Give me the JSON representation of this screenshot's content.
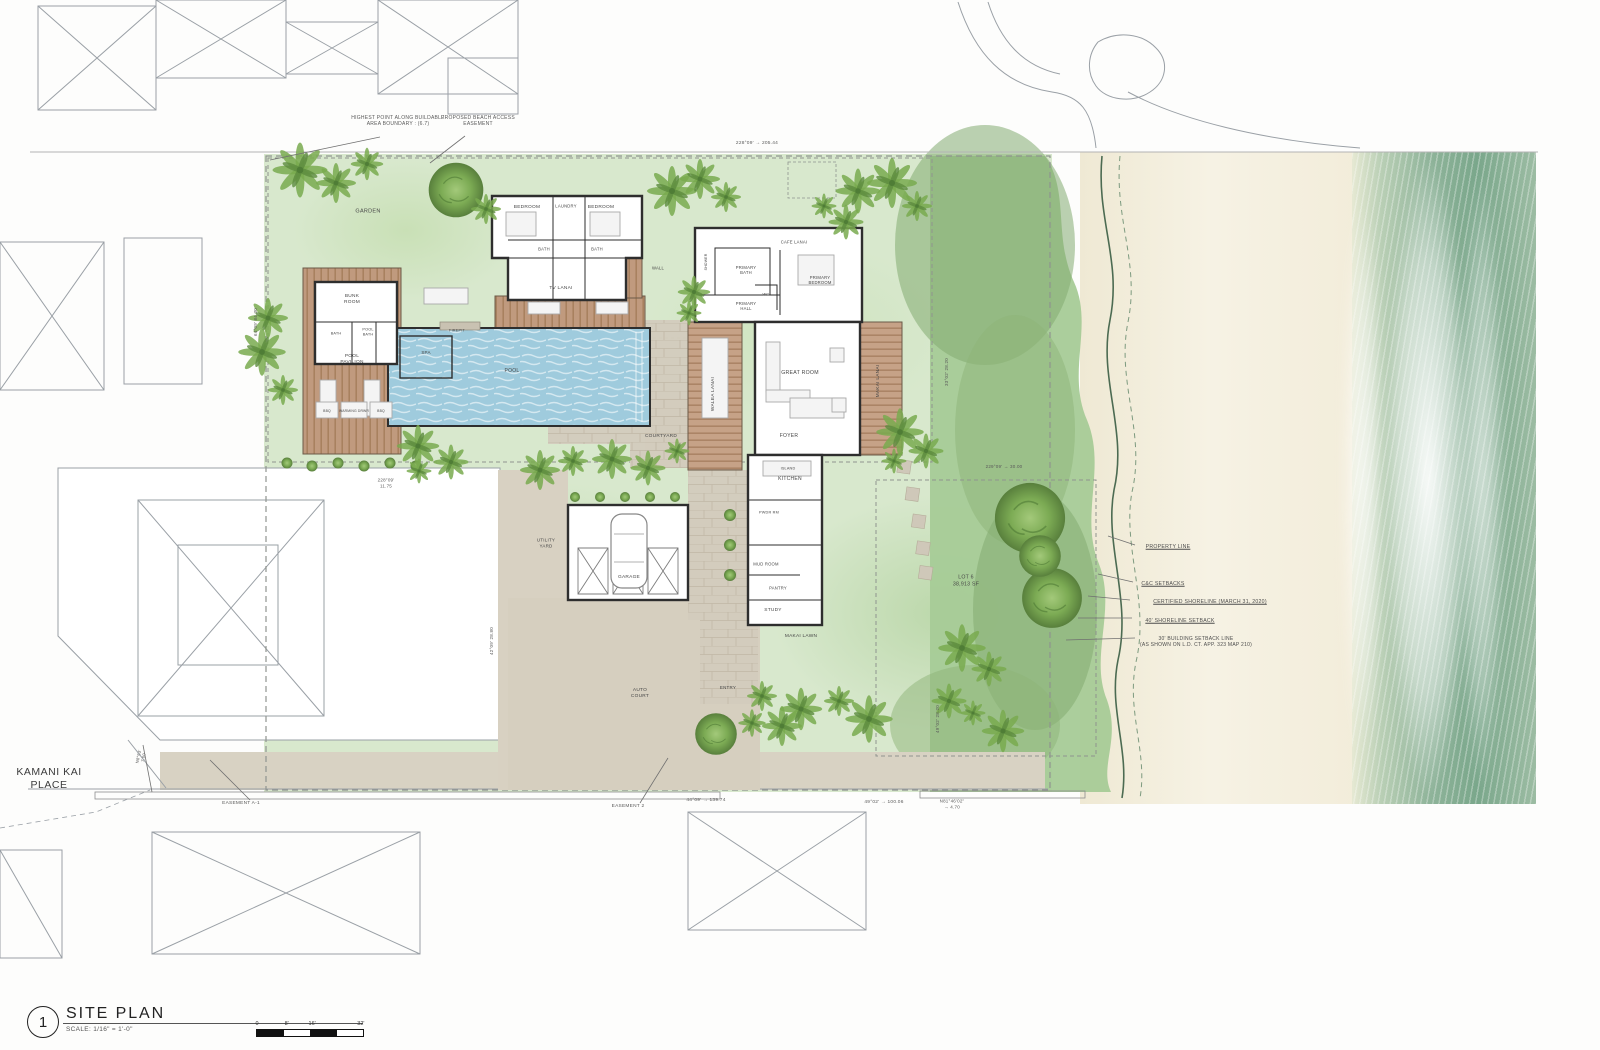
{
  "title_block": {
    "number": "1",
    "title": "SITE PLAN",
    "scale_note": "SCALE: 1/16\" =    1'-0\"",
    "ticks": [
      "0",
      "8'",
      "16'",
      "32'"
    ]
  },
  "street": {
    "name": "KAMANI KAI\nPLACE"
  },
  "site": {
    "lot_label": "LOT 6",
    "lot_area": "38,913 SF"
  },
  "colors": {
    "lawn": "#d8e8cd",
    "dune": "#a6cb97",
    "sand": "#f6f2e4",
    "ocean": "#7aa78b",
    "pool": "#9fcbdd",
    "deck": "#c09a7e",
    "wall": "#2e2e2e",
    "pavement": "#d8d1c2",
    "stone": "#d3ccbd",
    "neighbor_line": "#9aa0a6",
    "text": "#474747"
  },
  "labels": [
    {
      "n": "street-label",
      "t": "KAMANI KAI\nPLACE",
      "x": 49,
      "y": 779,
      "s": 10.5,
      "c": "#3c3c3c"
    },
    {
      "n": "label-garden",
      "t": "GARDEN",
      "x": 368,
      "y": 212,
      "s": 5.5
    },
    {
      "n": "label-bedroom-1",
      "t": "BEDROOM",
      "x": 527,
      "y": 208,
      "s": 4.8
    },
    {
      "n": "label-laundry",
      "t": "LAUNDRY",
      "x": 566,
      "y": 206,
      "s": 4.2
    },
    {
      "n": "label-bedroom-2",
      "t": "BEDROOM",
      "x": 601,
      "y": 208,
      "s": 4.8
    },
    {
      "n": "label-bath-1",
      "t": "BATH",
      "x": 544,
      "y": 249,
      "s": 4.2
    },
    {
      "n": "label-bath-2",
      "t": "BATH",
      "x": 597,
      "y": 249,
      "s": 4.2
    },
    {
      "n": "label-tv-lanai",
      "t": "TV LANAI",
      "x": 561,
      "y": 289,
      "s": 4.8
    },
    {
      "n": "label-cafe-lanai",
      "t": "CAFE LANAI",
      "x": 794,
      "y": 242,
      "s": 4.2
    },
    {
      "n": "label-primary-bath",
      "t": "PRIMARY\nBATH",
      "x": 746,
      "y": 270,
      "s": 4.2
    },
    {
      "n": "label-shower",
      "t": "SHOWER",
      "x": 706,
      "y": 262,
      "s": 3.5,
      "r": -90
    },
    {
      "n": "label-wc",
      "t": "WC",
      "x": 766,
      "y": 294,
      "s": 4
    },
    {
      "n": "label-primary-bedroom",
      "t": "PRIMARY\nBEDROOM",
      "x": 820,
      "y": 280,
      "s": 4.2
    },
    {
      "n": "label-primary-hall",
      "t": "PRIMARY\nHALL",
      "x": 746,
      "y": 306,
      "s": 4.2
    },
    {
      "n": "label-wall",
      "t": "WALL",
      "x": 658,
      "y": 268,
      "s": 4.2
    },
    {
      "n": "label-great-room",
      "t": "GREAT ROOM",
      "x": 800,
      "y": 373,
      "s": 5.2
    },
    {
      "n": "label-foyer",
      "t": "FOYER",
      "x": 789,
      "y": 436,
      "s": 5
    },
    {
      "n": "label-makai-lanai",
      "t": "MAKAI LANAI",
      "x": 879,
      "y": 381,
      "s": 4.8,
      "r": -90
    },
    {
      "n": "label-walea-lanai",
      "t": "WALEA LANAI",
      "x": 714,
      "y": 394,
      "s": 4.8,
      "r": -90
    },
    {
      "n": "label-courtyard",
      "t": "COURTYARD",
      "x": 661,
      "y": 437,
      "s": 4.8
    },
    {
      "n": "label-kitchen",
      "t": "KITCHEN",
      "x": 790,
      "y": 479,
      "s": 5
    },
    {
      "n": "label-island",
      "t": "ISLAND",
      "x": 788,
      "y": 469,
      "s": 3.8
    },
    {
      "n": "label-pwdr-rm",
      "t": "PWDR RM",
      "x": 769,
      "y": 513,
      "s": 3.8
    },
    {
      "n": "label-mud-room",
      "t": "MUD ROOM",
      "x": 766,
      "y": 564,
      "s": 4.2
    },
    {
      "n": "label-pantry",
      "t": "PANTRY",
      "x": 778,
      "y": 588,
      "s": 4.2
    },
    {
      "n": "label-study",
      "t": "STUDY",
      "x": 773,
      "y": 611,
      "s": 4.8
    },
    {
      "n": "label-bunk-room",
      "t": "BUNK\nROOM",
      "x": 352,
      "y": 300,
      "s": 4.8
    },
    {
      "n": "label-bath-3",
      "t": "BATH",
      "x": 336,
      "y": 334,
      "s": 3.8
    },
    {
      "n": "label-pool-bath",
      "t": "POOL\nBATH",
      "x": 368,
      "y": 332,
      "s": 3.8
    },
    {
      "n": "label-pool-pavilion",
      "t": "POOL\nPAVILION",
      "x": 352,
      "y": 360,
      "s": 4.8
    },
    {
      "n": "label-spa",
      "t": "SPA",
      "x": 426,
      "y": 353,
      "s": 4.5
    },
    {
      "n": "label-pool",
      "t": "POOL",
      "x": 512,
      "y": 371,
      "s": 5
    },
    {
      "n": "label-firepit",
      "t": "FIREPIT",
      "x": 457,
      "y": 331,
      "s": 3.8
    },
    {
      "n": "label-bbq-1",
      "t": "BBQ",
      "x": 327,
      "y": 411,
      "s": 3.4
    },
    {
      "n": "label-warming",
      "t": "WARMING DRWR",
      "x": 354,
      "y": 411,
      "s": 3.4
    },
    {
      "n": "label-bbq-2",
      "t": "BBQ",
      "x": 381,
      "y": 411,
      "s": 3.4
    },
    {
      "n": "label-utility-yard",
      "t": "UTILITY\nYARD",
      "x": 546,
      "y": 543,
      "s": 4.5
    },
    {
      "n": "label-garage",
      "t": "GARAGE",
      "x": 629,
      "y": 578,
      "s": 4.8
    },
    {
      "n": "label-auto-court",
      "t": "AUTO\nCOURT",
      "x": 640,
      "y": 694,
      "s": 4.8
    },
    {
      "n": "label-entry",
      "t": "ENTRY",
      "x": 728,
      "y": 688,
      "s": 4.5
    },
    {
      "n": "label-makai-lawn",
      "t": "MAKAI LAWN",
      "x": 801,
      "y": 637,
      "s": 4.8
    },
    {
      "n": "label-lot",
      "t": "LOT 6\n38,913 SF",
      "x": 966,
      "y": 581,
      "s": 5.2
    },
    {
      "n": "note-highest-point",
      "t": "HIGHEST POINT ALONG BUILDABLE\nAREA BOUNDARY : (6.7)",
      "x": 398,
      "y": 121,
      "s": 5,
      "c": "#5a5a5a"
    },
    {
      "n": "note-beach-access",
      "t": "PROPOSED BEACH ACCESS\nEASEMENT",
      "x": 478,
      "y": 121,
      "s": 5,
      "c": "#5a5a5a"
    },
    {
      "n": "dim-top",
      "t": "228°09'   →   205.44",
      "x": 757,
      "y": 144,
      "s": 4.8,
      "c": "#5a5a5a"
    },
    {
      "n": "note-property-line",
      "t": "PROPERTY LINE",
      "x": 1168,
      "y": 547,
      "s": 5.2,
      "u": true,
      "c": "#4c4c4c"
    },
    {
      "n": "note-cc-setbacks",
      "t": "C&C SETBACKS",
      "x": 1163,
      "y": 584,
      "s": 5.2,
      "u": true,
      "c": "#4c4c4c"
    },
    {
      "n": "note-certified-shoreline",
      "t": "CERTIFIED SHORELINE (MARCH 31, 2020)",
      "x": 1210,
      "y": 602,
      "s": 5.2,
      "u": true,
      "c": "#4c4c4c"
    },
    {
      "n": "note-shoreline-setback",
      "t": "40' SHORELINE SETBACK",
      "x": 1180,
      "y": 621,
      "s": 5.2,
      "u": true,
      "c": "#4c4c4c"
    },
    {
      "n": "note-building-setback",
      "t": "30' BUILDING SETBACK LINE\n(AS SHOWN ON L.D. CT. APP. 323 MAP 210)",
      "x": 1196,
      "y": 642,
      "s": 5,
      "c": "#4c4c4c"
    },
    {
      "n": "note-easement-a1",
      "t": "EASEMENT A-1",
      "x": 241,
      "y": 804,
      "s": 4.8,
      "c": "#5a5a5a"
    },
    {
      "n": "dim-bottom-1",
      "t": "44°09'   →   139.74",
      "x": 706,
      "y": 801,
      "s": 4.8,
      "c": "#5a5a5a"
    },
    {
      "n": "dim-bottom-2",
      "t": "N81°46'02\"\n→ 4.70",
      "x": 952,
      "y": 804,
      "s": 4.5,
      "c": "#5a5a5a"
    },
    {
      "n": "note-easement-2",
      "t": "EASEMENT 2",
      "x": 628,
      "y": 807,
      "s": 4.8,
      "c": "#5a5a5a"
    },
    {
      "n": "dim-bottom-3",
      "t": "49°02'   →   100.06",
      "x": 884,
      "y": 803,
      "s": 4.8,
      "c": "#5a5a5a"
    },
    {
      "n": "dim-left-1",
      "t": "64°09'   84.30",
      "x": 256,
      "y": 322,
      "s": 4.5,
      "r": -90,
      "c": "#5a5a5a"
    },
    {
      "n": "dim-mid-1",
      "t": "228°09'\n11.75",
      "x": 386,
      "y": 483,
      "s": 4.5,
      "c": "#5a5a5a"
    },
    {
      "n": "dim-left-2",
      "t": "42°09'   28.80",
      "x": 492,
      "y": 641,
      "s": 4.5,
      "r": -90,
      "c": "#5a5a5a"
    },
    {
      "n": "dim-right-1",
      "t": "33°02'   28.20",
      "x": 947,
      "y": 372,
      "s": 4.5,
      "r": -90,
      "c": "#5a5a5a"
    },
    {
      "n": "dim-right-2",
      "t": "229°09'   →   30.00",
      "x": 1004,
      "y": 467,
      "s": 4.5,
      "c": "#5a5a5a"
    },
    {
      "n": "dim-right-3",
      "t": "49°02'   28.20",
      "x": 938,
      "y": 719,
      "s": 4.5,
      "r": -90,
      "c": "#5a5a5a"
    },
    {
      "n": "dim-street",
      "t": "N8°53'\n7.00",
      "x": 141,
      "y": 757,
      "s": 4.2,
      "r": -78,
      "c": "#5a5a5a"
    }
  ]
}
